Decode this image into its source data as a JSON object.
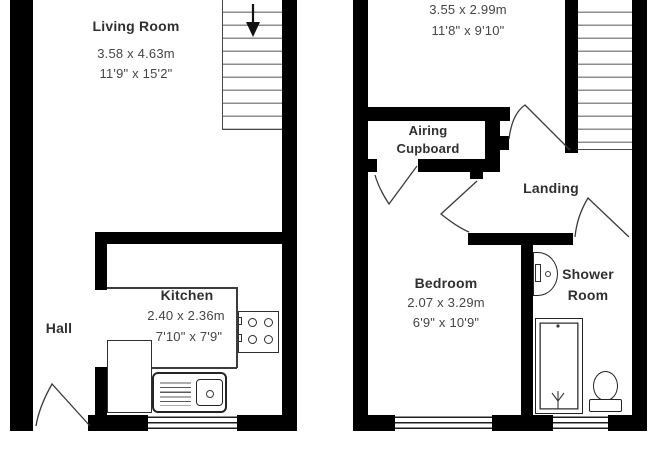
{
  "ground_floor": {
    "living_room": {
      "name": "Living Room",
      "size_metric": "3.58 x 4.63m",
      "size_imperial": "11'9\" x 15'2\""
    },
    "hall": {
      "name": "Hall"
    },
    "kitchen": {
      "name": "Kitchen",
      "size_metric": "2.40 x 2.36m",
      "size_imperial": "7'10\" x 7'9\""
    }
  },
  "first_floor": {
    "bedroom_front": {
      "size_metric": "3.55 x 2.99m",
      "size_imperial": "11'8\" x 9'10\""
    },
    "airing_cupboard": {
      "name_line_1": "Airing",
      "name_line_2": "Cupboard"
    },
    "landing": {
      "name": "Landing"
    },
    "bedroom_rear": {
      "name": "Bedroom",
      "size_metric": "2.07 x 3.29m",
      "size_imperial": "6'9\" x 10'9\""
    },
    "shower_room": {
      "name_line_1": "Shower",
      "name_line_2": "Room"
    }
  },
  "icons": {
    "stairs-down-arrow-icon": "▼ down arrow on staircase",
    "hob-icon": "4 burner rings with 2 control knobs",
    "sink-icon": "drainer lines + square bowl with plug dot",
    "basin-icon": "half-round wash basin with tap block",
    "shower-head-icon": "spray symbol in shower tray",
    "toilet-icon": "oval bowl with cistern"
  },
  "colors": {
    "wall": "#000000",
    "fixture_line": "#2f2f2f",
    "stair_step_line": "#8d8d8d",
    "text": "#303030",
    "background": "#ffffff"
  }
}
